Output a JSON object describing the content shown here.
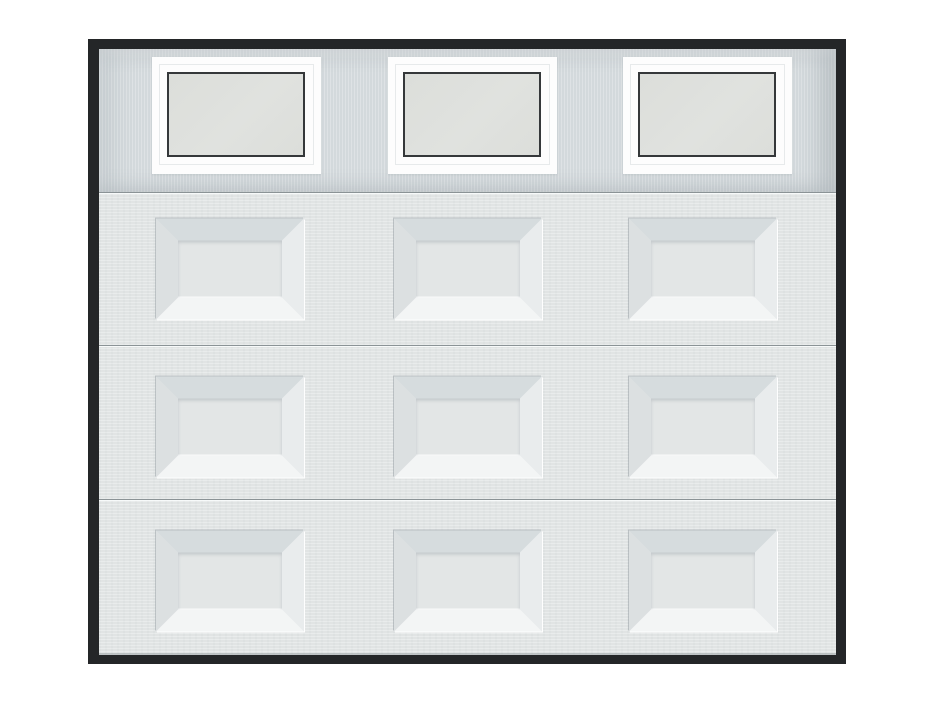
{
  "description": "Product image of a white sectional garage door with a black outer frame: top section with three rectangular windows, and three lower sections each with three raised beveled panels",
  "door": {
    "sections": 4,
    "windows": {
      "count": 3
    },
    "raised_panels": {
      "rows": 3,
      "columns": 3,
      "total": 9
    }
  },
  "colors": {
    "page-bg": "#ffffff",
    "frame-black": "#242628",
    "top-section-bg": "#d3d9dc",
    "section-bg": "#e1e4e4",
    "seam-line": "#8b9396",
    "window-frame-white": "#fdfdfd",
    "window-border-dark": "#35383a",
    "window-glass": "#dcdeda",
    "bevel-top": "#d6dcde",
    "bevel-left": "#dce0e1",
    "bevel-right": "#e9eced",
    "bevel-bottom": "#f3f5f5",
    "panel-center": "#e3e6e6"
  }
}
